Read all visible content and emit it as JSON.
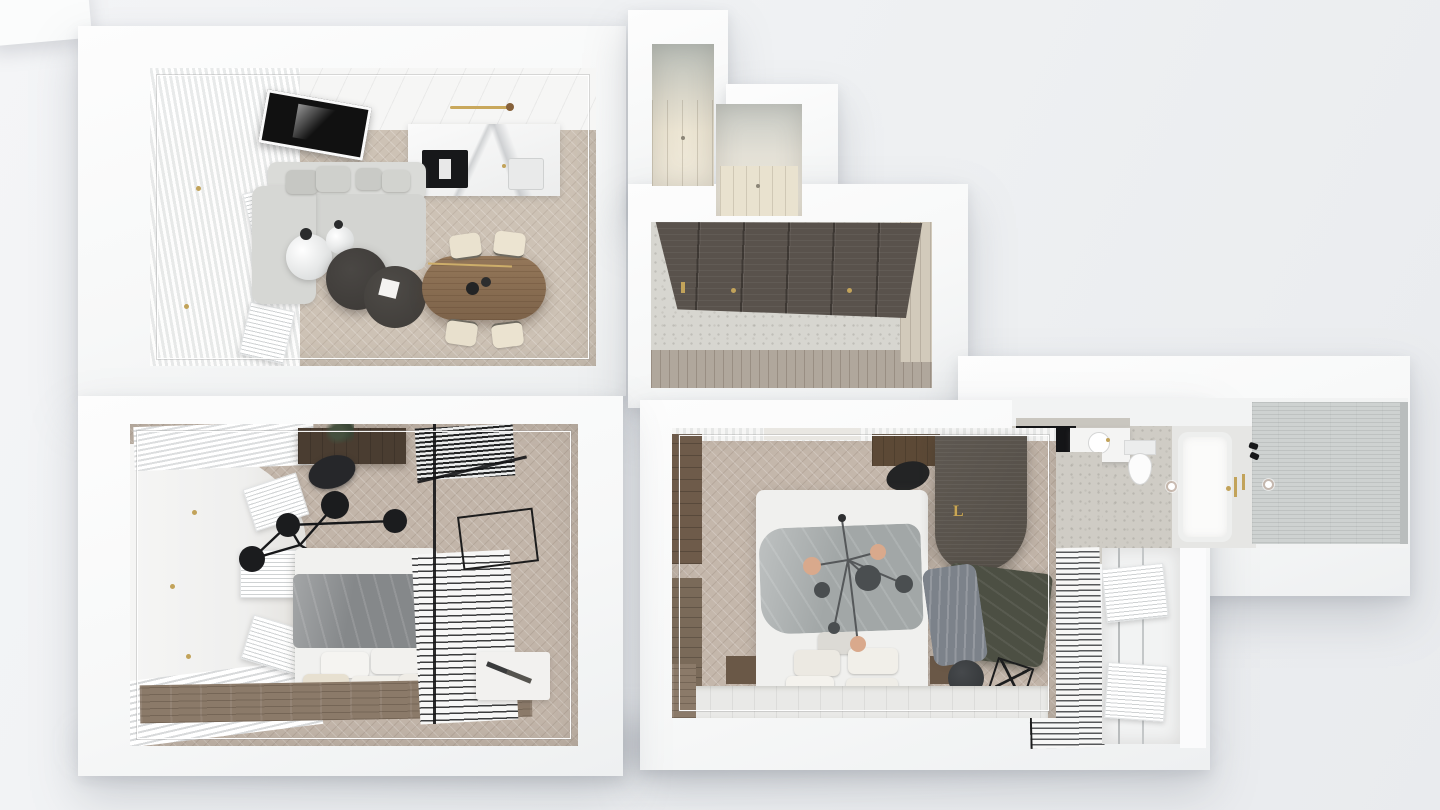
{
  "scene": {
    "monogram": "L"
  },
  "colors": {
    "background": "#eff1f3",
    "wall_white": "#fafbfb",
    "living_floor": "#cdc2b5",
    "bedroom_floor": "#c2b5a9",
    "hall_wardrobe_dark": "#59524c",
    "hall_floor_terrazzo": "#d7d6d0",
    "closet_cream": "#ece5d3",
    "wood_strip": "#8b7a69",
    "sofa_gray": "#d5d6d3",
    "dining_table_wood": "#8a6e52",
    "coffee_table_dark": "#413e3b",
    "duvet_bedroom1": "#888b8d",
    "duvet_bedroom2": "#a2a7a7",
    "daybed_olive": "#4c4f43",
    "throw_gray": "#7c828a",
    "feature_wall_dark": "#59534c",
    "brass_gold": "#c2a35a",
    "bathroom_terrazzo": "#cfccc5",
    "shower_tile": "#ced2d1",
    "vanity_black": "#141517",
    "chandelier_black": "#1b1c1e",
    "chandelier_peach": "#d9a98c"
  }
}
